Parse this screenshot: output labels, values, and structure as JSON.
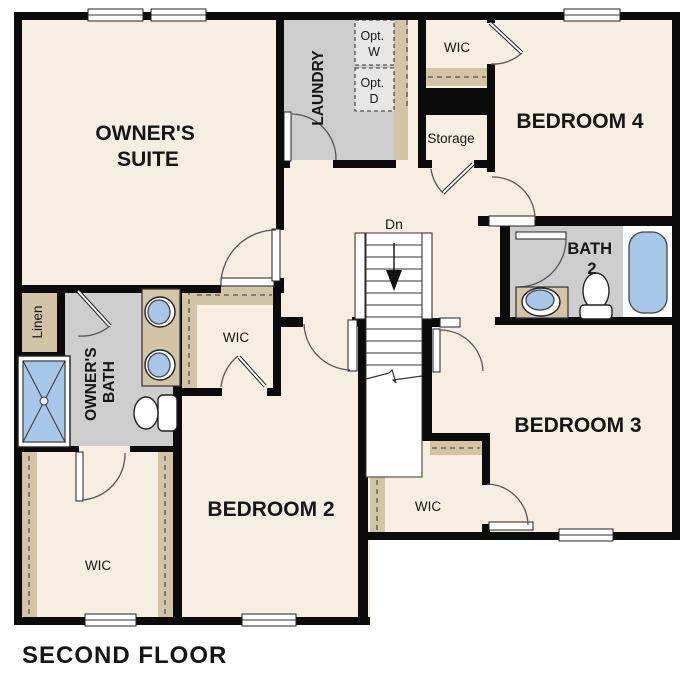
{
  "title": "SECOND FLOOR",
  "stairs": {
    "direction_label": "Dn"
  },
  "rooms": {
    "owners_suite": {
      "line1": "OWNER'S",
      "line2": "SUITE"
    },
    "laundry": {
      "label": "LAUNDRY"
    },
    "opt_washer": {
      "line1": "Opt.",
      "line2": "W"
    },
    "opt_dryer": {
      "line1": "Opt.",
      "line2": "D"
    },
    "wic_top": {
      "label": "WIC"
    },
    "storage": {
      "label": "Storage"
    },
    "bedroom4": {
      "label": "BEDROOM 4"
    },
    "bath2": {
      "line1": "BATH",
      "line2": "2"
    },
    "bedroom3": {
      "label": "BEDROOM 3"
    },
    "wic_middle": {
      "label": "WIC"
    },
    "bedroom2": {
      "label": "BEDROOM 2"
    },
    "owners_wic": {
      "label": "WIC"
    },
    "owners_bath": {
      "line1": "OWNER'S",
      "line2": "BATH"
    },
    "linen": {
      "label": "Linen"
    },
    "wic_bottom_left": {
      "label": "WIC"
    }
  },
  "colors": {
    "floor": "#f6eee1",
    "tile_floor": "#cdcdcd",
    "closet_shelf": "#d3c4a6",
    "fixture_blue": "#a7c7e8",
    "wall": "#0b0b0b"
  }
}
